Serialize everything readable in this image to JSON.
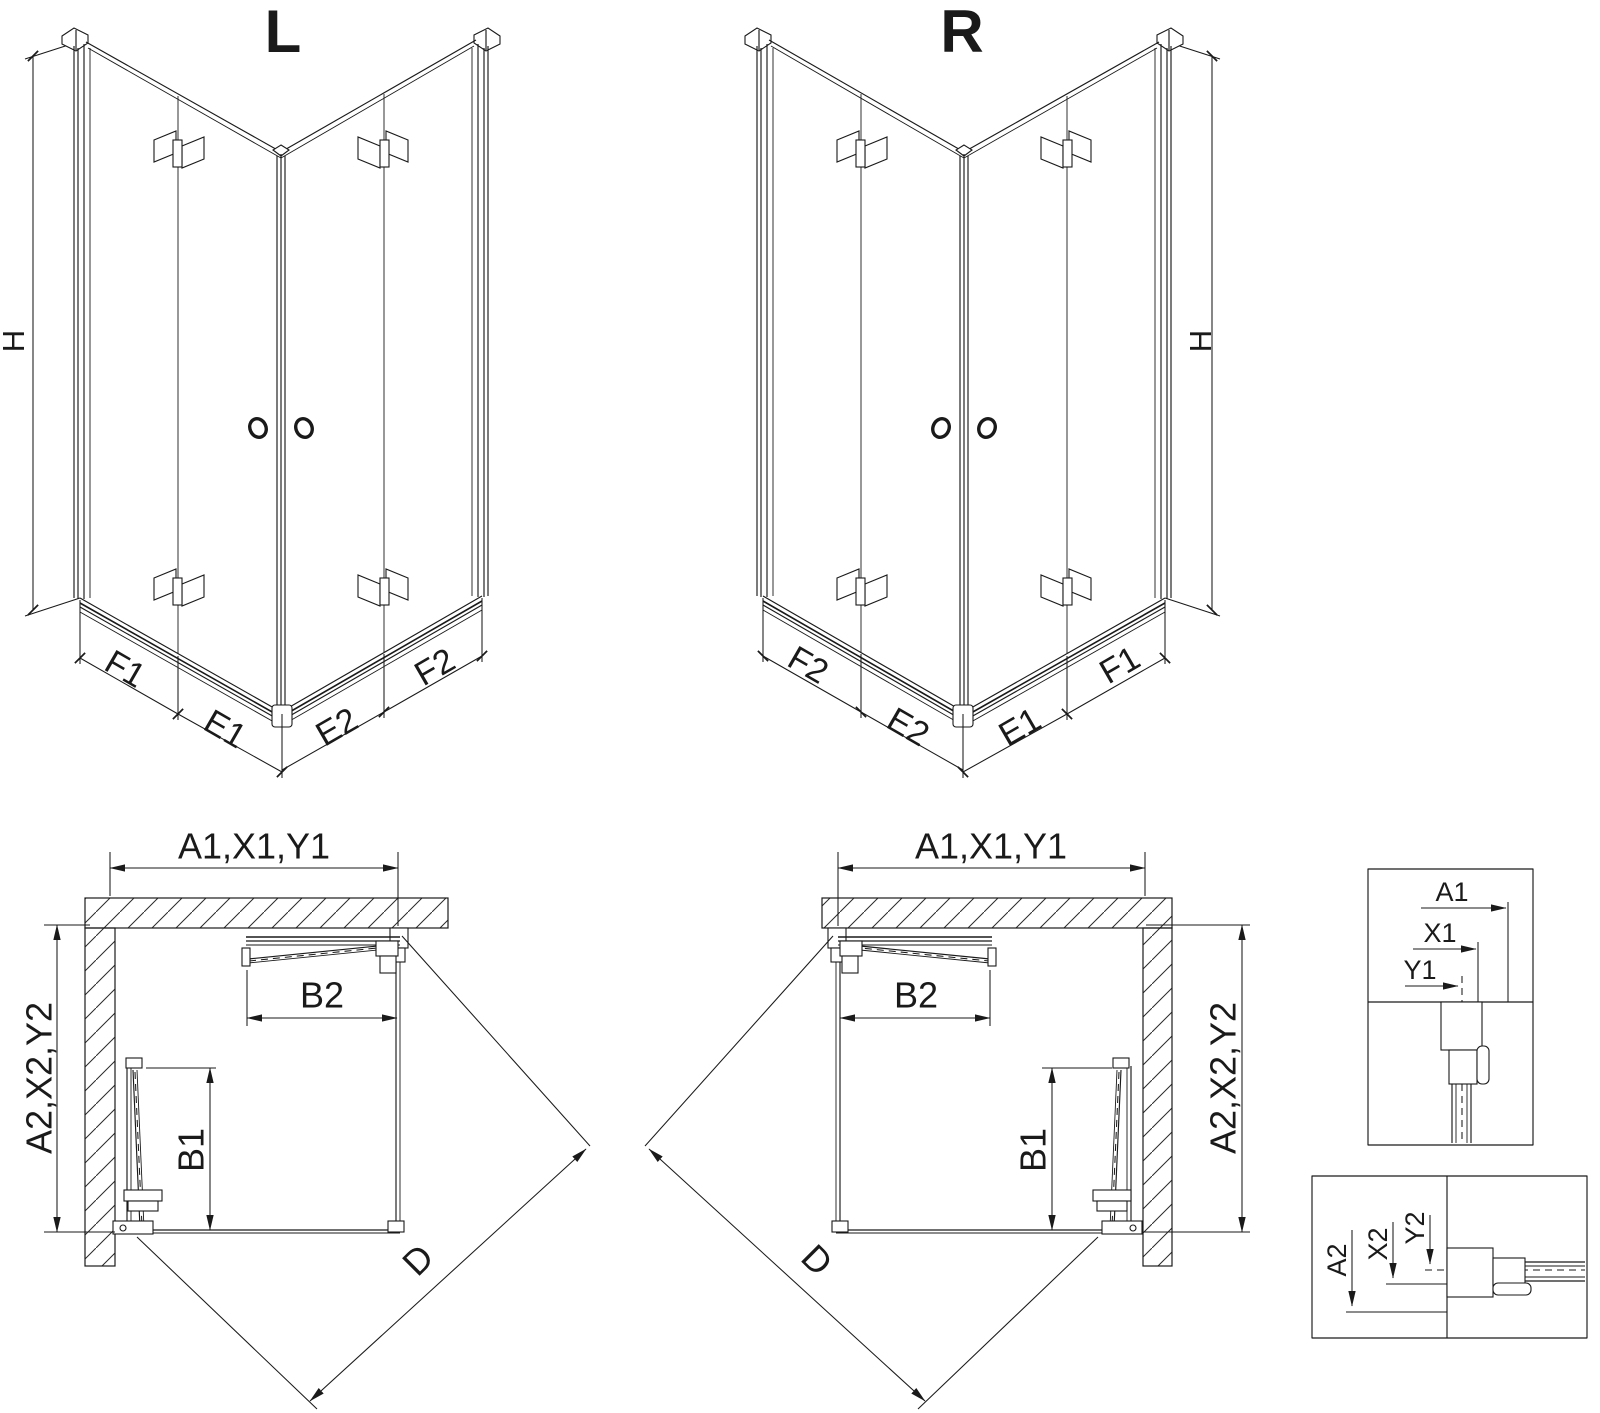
{
  "drawing": {
    "colors": {
      "line": "#1a1a1a",
      "background": "#ffffff"
    },
    "views": {
      "iso_left": {
        "label": "L",
        "height_label": "H",
        "bottom_dims": [
          "F1",
          "E1",
          "E2",
          "F2"
        ]
      },
      "iso_right": {
        "label": "R",
        "height_label": "H",
        "bottom_dims": [
          "F2",
          "E2",
          "E1",
          "F1"
        ]
      },
      "plan_left": {
        "width_label": "A1,X1,Y1",
        "depth_label": "A2,X2,Y2",
        "door_top_label": "B2",
        "door_side_label": "B1",
        "diagonal_label": "D"
      },
      "plan_right": {
        "width_label": "A1,X1,Y1",
        "depth_label": "A2,X2,Y2",
        "door_top_label": "B2",
        "door_side_label": "B1",
        "diagonal_label": "D"
      },
      "detail_wall_profile_top": {
        "dim_labels": [
          "A1",
          "X1",
          "Y1"
        ]
      },
      "detail_wall_profile_side": {
        "dim_labels": [
          "A2",
          "X2",
          "Y2"
        ]
      }
    }
  }
}
